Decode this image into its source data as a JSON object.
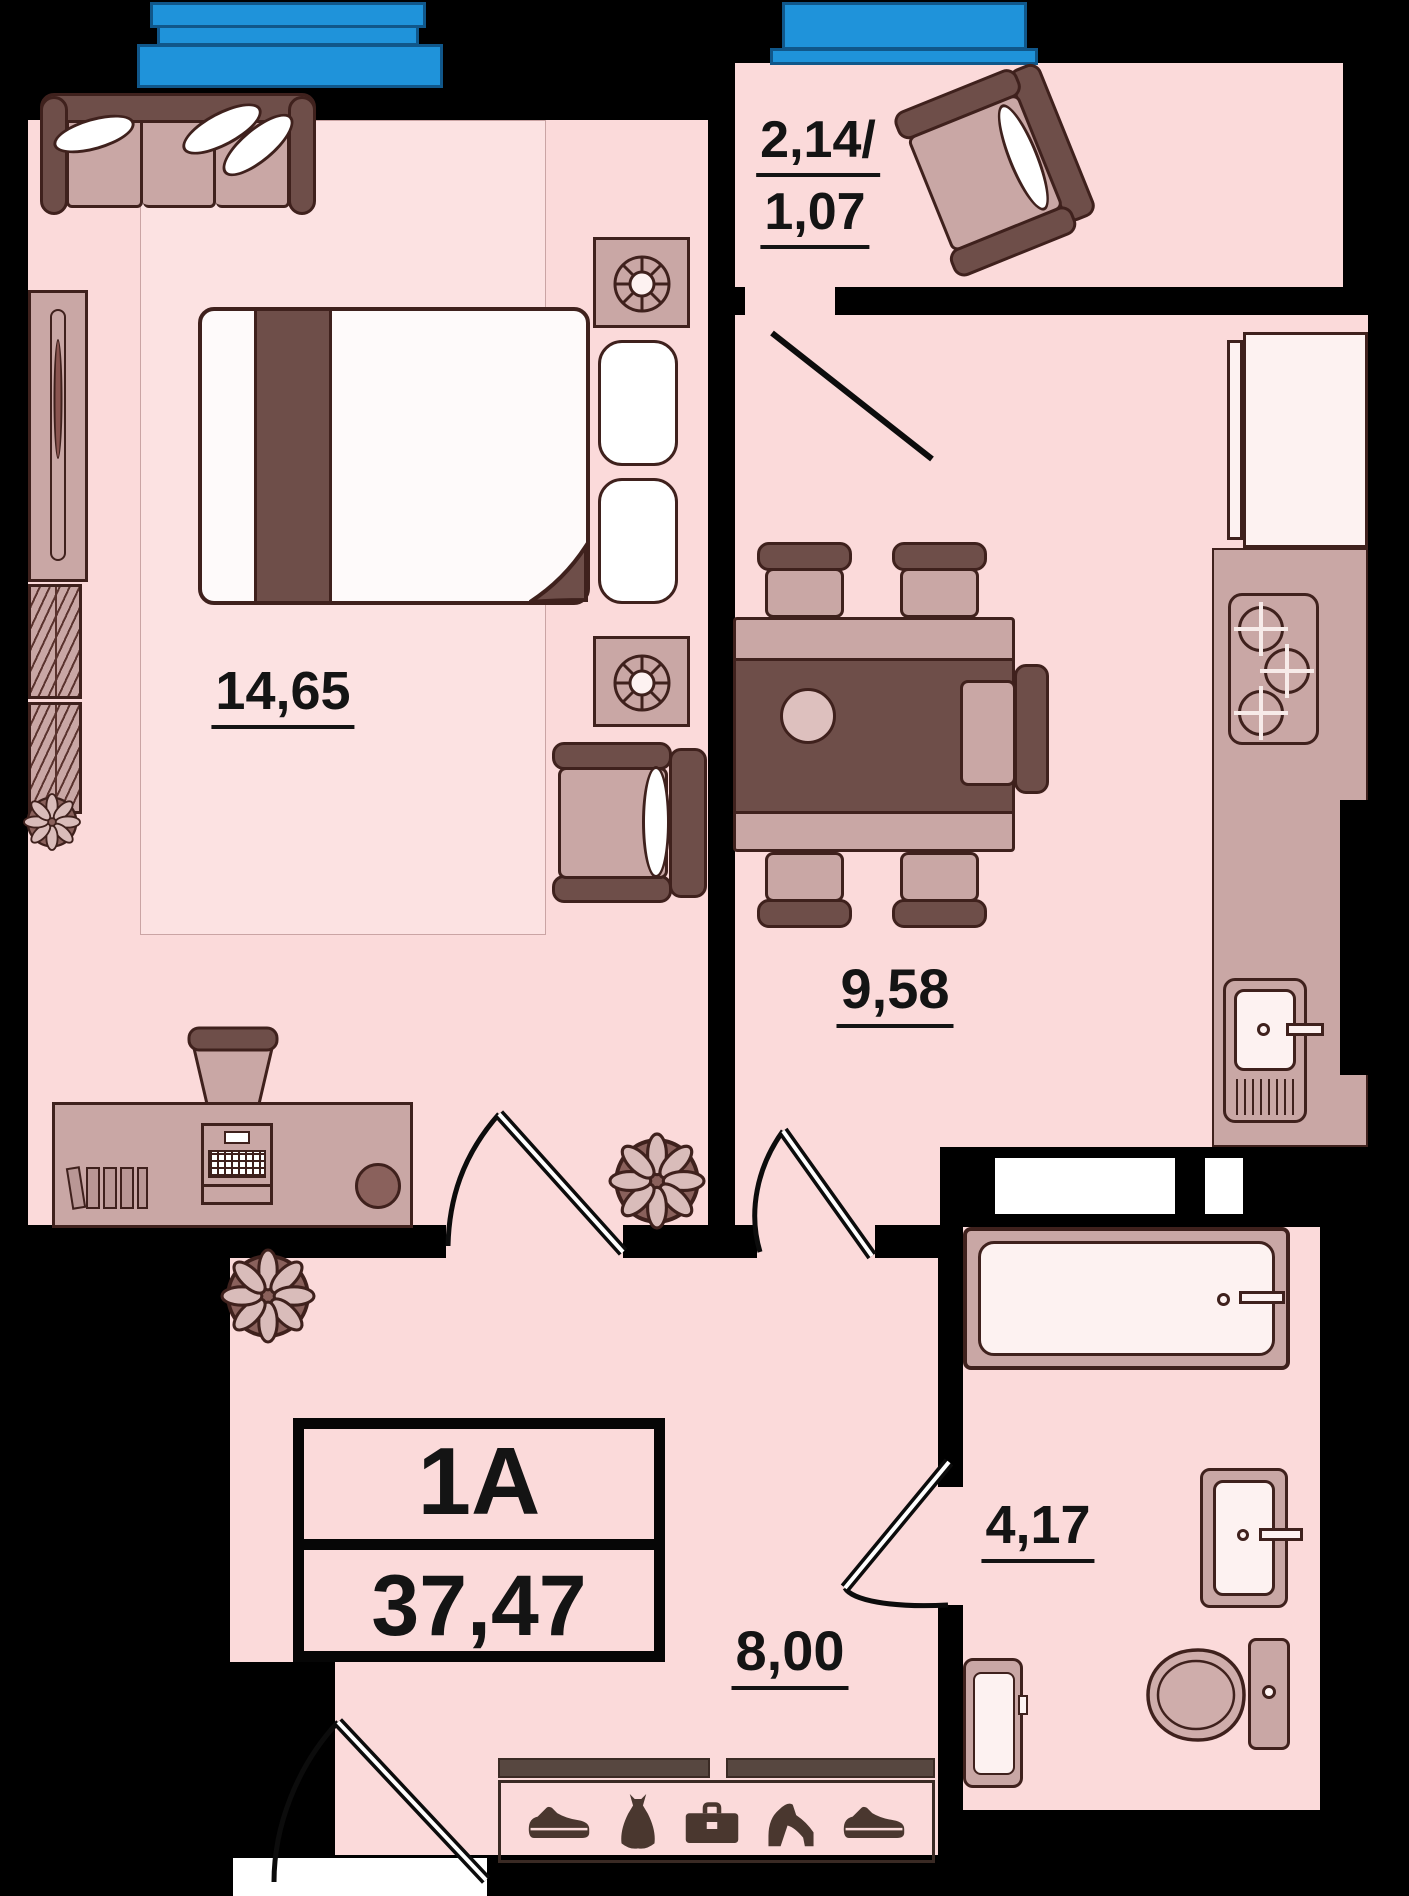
{
  "plate": {
    "unit_label": "1A",
    "total_area": "37,47"
  },
  "rooms": {
    "bedroom": {
      "area": "14,65"
    },
    "kitchen": {
      "area": "9,58"
    },
    "balcony": {
      "area_top": "2,14/",
      "area_bottom": "1,07"
    },
    "hallway": {
      "area": "8,00"
    },
    "bathroom": {
      "area": "4,17"
    }
  },
  "palette": {
    "floor_pink": "#fbdada",
    "wall_black": "#000000",
    "furniture_dark_brown": "#6e4e49",
    "furniture_mauve": "#c9a7a5",
    "outline_maroon": "#3f211d",
    "window_blue": "#1f93da",
    "fixture_white": "#fdf2f1"
  },
  "icons": {
    "wardrobe_row": [
      "sneaker-icon",
      "dress-icon",
      "briefcase-icon",
      "high-heel-icon",
      "sneaker-icon"
    ]
  }
}
